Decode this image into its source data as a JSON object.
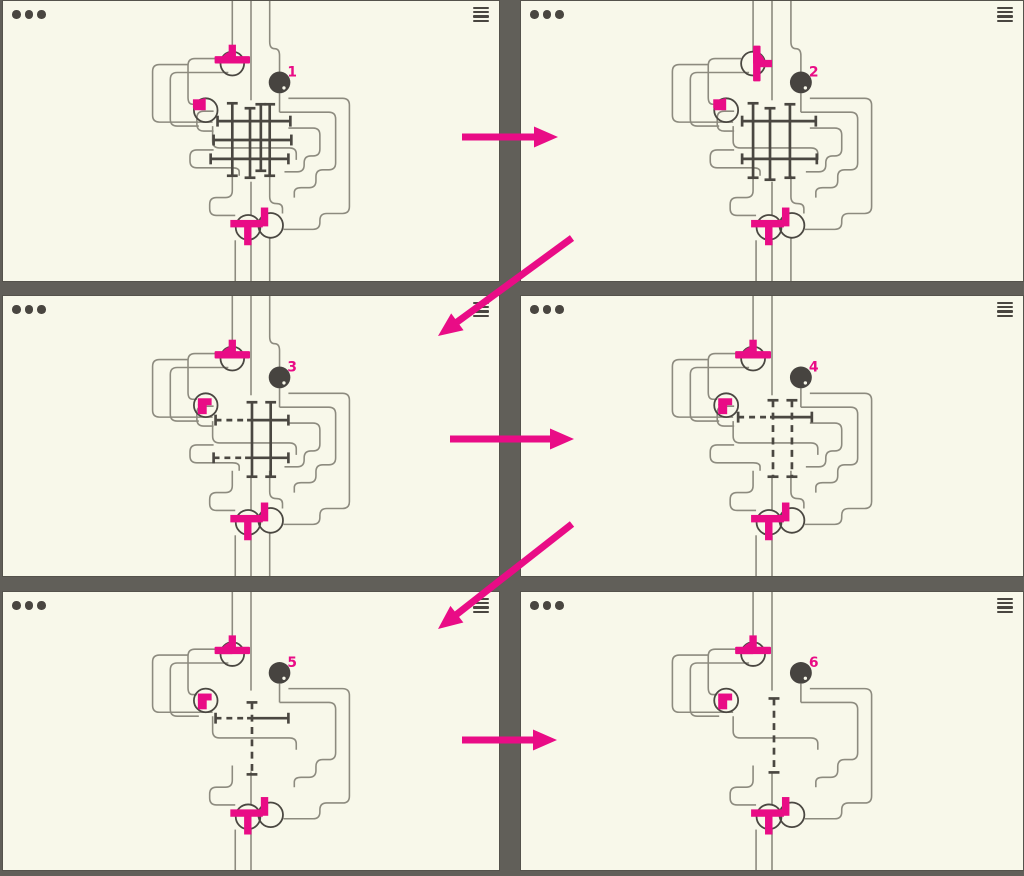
{
  "colors": {
    "panel_background": "#f8f8ea",
    "frame_gray": "#615f59",
    "chrome_gray": "#494640",
    "wire_gray": "#8d8b7f",
    "ink_dark": "#4a4741",
    "ball_dark": "#474440",
    "magenta": "#e90c86"
  },
  "chrome": {
    "window_dots": 3,
    "menu_icon": "hamburger-menu-icon",
    "dots_icon": "three-dots-icon"
  },
  "windows": [
    {
      "name": "puzzle-window-1",
      "step_label": "1",
      "left": 2,
      "top": 0,
      "width": 498,
      "height": 282,
      "wires": "A",
      "top_rot": 0,
      "left_style": "wedge",
      "hash": {
        "h": [
          {
            "y": 121,
            "x1": 218,
            "x2": 292,
            "dash": "none"
          },
          {
            "y": 140,
            "x1": 214,
            "x2": 293,
            "dash": "none"
          },
          {
            "y": 159,
            "x1": 211,
            "x2": 290,
            "dash": "none"
          }
        ],
        "v": [
          {
            "x": 233,
            "y1": 103,
            "y2": 176,
            "dash": false
          },
          {
            "x": 251,
            "y1": 108,
            "y2": 178,
            "dash": false
          },
          {
            "x": 262,
            "y1": 104,
            "y2": 171,
            "dash": false
          },
          {
            "x": 271,
            "y1": 104,
            "y2": 176,
            "dash": false
          }
        ]
      }
    },
    {
      "name": "puzzle-window-2",
      "step_label": "2",
      "left": 520,
      "top": 0,
      "width": 504,
      "height": 282,
      "wires": "A",
      "top_rot": 90,
      "left_style": "wedge",
      "hash": {
        "h": [
          {
            "y": 121,
            "x1": 222,
            "x2": 296,
            "dash": "none"
          },
          {
            "y": 159,
            "x1": 222,
            "x2": 297,
            "dash": "none"
          }
        ],
        "v": [
          {
            "x": 233,
            "y1": 103,
            "y2": 178,
            "dash": false
          },
          {
            "x": 250,
            "y1": 108,
            "y2": 180,
            "dash": false
          },
          {
            "x": 270,
            "y1": 104,
            "y2": 178,
            "dash": false
          }
        ]
      }
    },
    {
      "name": "puzzle-window-3",
      "step_label": "3",
      "left": 2,
      "top": 295,
      "width": 498,
      "height": 282,
      "wires": "A",
      "top_rot": 0,
      "left_style": "corner",
      "hash": {
        "h": [
          {
            "y": 125,
            "x1": 216,
            "x2": 290,
            "dash": "left"
          },
          {
            "y": 163,
            "x1": 214,
            "x2": 290,
            "dash": "left"
          }
        ],
        "v": [
          {
            "x": 253,
            "y1": 107,
            "y2": 182,
            "dash": false
          },
          {
            "x": 272,
            "y1": 107,
            "y2": 182,
            "dash": false
          }
        ]
      }
    },
    {
      "name": "puzzle-window-4",
      "step_label": "4",
      "left": 520,
      "top": 295,
      "width": 504,
      "height": 282,
      "wires": "B",
      "top_rot": 0,
      "left_style": "corner",
      "hash": {
        "h": [
          {
            "y": 122,
            "x1": 218,
            "x2": 292,
            "dash": "left"
          }
        ],
        "v": [
          {
            "x": 253,
            "y1": 105,
            "y2": 182,
            "dash": true
          },
          {
            "x": 272,
            "y1": 105,
            "y2": 182,
            "dash": true
          }
        ]
      }
    },
    {
      "name": "puzzle-window-5",
      "step_label": "5",
      "left": 2,
      "top": 591,
      "width": 498,
      "height": 280,
      "wires": "C",
      "top_rot": 0,
      "left_style": "corner",
      "hash": {
        "h": [
          {
            "y": 128,
            "x1": 216,
            "x2": 290,
            "dash": "left"
          }
        ],
        "v": [
          {
            "x": 253,
            "y1": 112,
            "y2": 185,
            "dash": true
          }
        ]
      }
    },
    {
      "name": "puzzle-window-6",
      "step_label": "6",
      "left": 520,
      "top": 591,
      "width": 504,
      "height": 280,
      "wires": "C",
      "top_rot": 0,
      "left_style": "corner",
      "hash": {
        "h": [],
        "v": [
          {
            "x": 254,
            "y1": 108,
            "y2": 183,
            "dash": true
          }
        ]
      }
    }
  ],
  "arrows": [
    {
      "name": "flow-arrow-step-1-2",
      "x1": 462,
      "y1": 137,
      "x2": 558,
      "y2": 137
    },
    {
      "name": "flow-arrow-step-2-3",
      "x1": 572,
      "y1": 238,
      "x2": 438,
      "y2": 336
    },
    {
      "name": "flow-arrow-step-3-4",
      "x1": 450,
      "y1": 439,
      "x2": 574,
      "y2": 439
    },
    {
      "name": "flow-arrow-step-4-5",
      "x1": 572,
      "y1": 524,
      "x2": 438,
      "y2": 629
    },
    {
      "name": "flow-arrow-step-5-6",
      "x1": 462,
      "y1": 740,
      "x2": 557,
      "y2": 740
    }
  ],
  "diagram": {
    "viewbox": [
      0,
      0,
      504,
      282
    ],
    "corner_radius": 7,
    "nodes": {
      "top": {
        "cx": 233,
        "cy": 63,
        "r": 12
      },
      "left": {
        "cx": 206,
        "cy": 110,
        "r": 12
      },
      "bottom_left": {
        "cx": 249,
        "cy": 228,
        "r": 12.5
      },
      "bottom_right": {
        "cx": 272,
        "cy": 226,
        "r": 12.5
      },
      "ball": {
        "cx": 281,
        "cy": 82,
        "r": 11
      },
      "label_x": 289,
      "label_y": 76
    },
    "wires_base": [
      [
        [
          233,
          0
        ],
        [
          233,
          52
        ]
      ],
      [
        [
          252,
          0
        ],
        [
          252,
          100
        ]
      ],
      [
        [
          281,
          93
        ],
        [
          281,
          112
        ]
      ],
      [
        [
          221,
          58
        ],
        [
          188,
          58
        ],
        [
          188,
          104
        ],
        [
          197,
          104
        ]
      ],
      [
        [
          229,
          72
        ],
        [
          170,
          72
        ],
        [
          170,
          126
        ],
        [
          199,
          126
        ]
      ],
      [
        [
          188,
          64
        ],
        [
          152,
          64
        ],
        [
          152,
          122
        ],
        [
          213,
          122
        ]
      ],
      [
        [
          281,
          112
        ],
        [
          338,
          112
        ],
        [
          338,
          170
        ],
        [
          318,
          170
        ],
        [
          318,
          188
        ],
        [
          296,
          188
        ],
        [
          296,
          198
        ]
      ],
      [
        [
          290,
          98
        ],
        [
          352,
          98
        ],
        [
          352,
          214
        ],
        [
          322,
          214
        ],
        [
          322,
          230
        ],
        [
          285,
          230
        ]
      ],
      [
        [
          213,
          126
        ],
        [
          213,
          148
        ],
        [
          298,
          148
        ],
        [
          298,
          160
        ]
      ],
      [
        [
          233,
          176
        ],
        [
          233,
          198
        ],
        [
          210,
          198
        ],
        [
          210,
          216
        ],
        [
          236,
          216
        ]
      ],
      [
        [
          252,
          182
        ],
        [
          252,
          216
        ]
      ],
      [
        [
          236,
          241
        ],
        [
          236,
          282
        ]
      ],
      [
        [
          252,
          241
        ],
        [
          252,
          282
        ]
      ]
    ],
    "wires_mid": [
      [
        [
          214,
          111
        ],
        [
          197,
          111
        ],
        [
          197,
          131
        ],
        [
          214,
          131
        ]
      ],
      [
        [
          214,
          150
        ],
        [
          190,
          150
        ],
        [
          190,
          168
        ],
        [
          240,
          168
        ],
        [
          240,
          176
        ]
      ],
      [
        [
          290,
          128
        ],
        [
          322,
          128
        ],
        [
          322,
          156
        ],
        [
          306,
          156
        ],
        [
          306,
          172
        ],
        [
          286,
          172
        ]
      ],
      [
        [
          271,
          176
        ],
        [
          271,
          204
        ],
        [
          284,
          204
        ],
        [
          284,
          214
        ]
      ]
    ],
    "wires_feed3": [
      [
        [
          271,
          0
        ],
        [
          271,
          48
        ],
        [
          281,
          48
        ],
        [
          281,
          71
        ]
      ],
      [
        [
          271,
          238
        ],
        [
          271,
          282
        ]
      ]
    ]
  }
}
